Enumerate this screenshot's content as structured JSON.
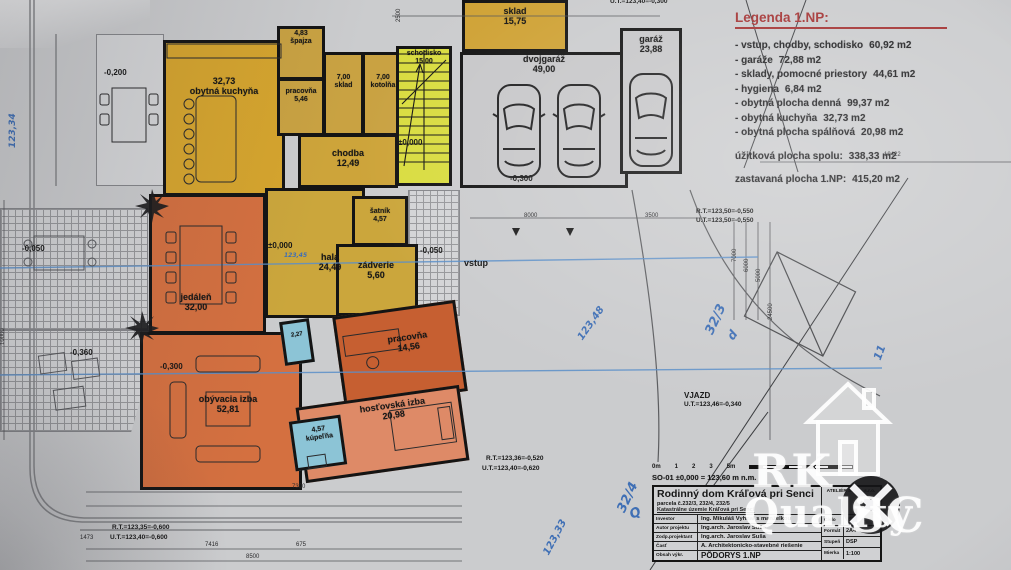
{
  "plan": {
    "rooms": [
      {
        "name": "obytná kuchyňa",
        "area": "32,73"
      },
      {
        "name": "špajza",
        "area": "4,83"
      },
      {
        "name": "pracovňa",
        "area": "5,46"
      },
      {
        "name": "sklad",
        "area": "7,00"
      },
      {
        "name": "kotolňa",
        "area": "7,00"
      },
      {
        "name": "chodba",
        "area": "12,49"
      },
      {
        "name": "schodisko",
        "area": "15,00"
      },
      {
        "name": "sklad",
        "area": "15,75"
      },
      {
        "name": "dvojgaráž",
        "area": "49,00"
      },
      {
        "name": "garáž",
        "area": "23,88"
      },
      {
        "name": "hala",
        "area": "24,49"
      },
      {
        "name": "šatník",
        "area": "4,57"
      },
      {
        "name": "zádverie",
        "area": "5,60"
      },
      {
        "name": "jedáleň",
        "area": "32,00"
      },
      {
        "name": "obývacia izba",
        "area": "52,81"
      },
      {
        "name": "pracovňa",
        "area": "14,56"
      },
      {
        "name": "hosťovská izba",
        "area": "20,98"
      },
      {
        "name": "kúpeľňa",
        "area": "4,57"
      },
      {
        "name": "WC",
        "area": "2,27"
      }
    ],
    "annotations": [
      {
        "text": "±0,000"
      },
      {
        "text": "±0,000"
      },
      {
        "text": "-0,300"
      },
      {
        "text": "-0,200"
      },
      {
        "text": "-0,050"
      },
      {
        "text": "-0,050"
      },
      {
        "text": "-0,300"
      },
      {
        "text": "-0,360"
      },
      {
        "text": "vstup"
      },
      {
        "text": "VJAZD"
      },
      {
        "text": "U.T.=123,46=-0,340"
      },
      {
        "text": "R.T.=123,50=-0,550"
      },
      {
        "text": "U.T.=123,50=-0,550"
      },
      {
        "text": "R.T.=123,36=-0,520"
      },
      {
        "text": "U.T.=123,40=-0,620"
      },
      {
        "text": "R.T.=123,35=-0,600"
      },
      {
        "text": "U.T.=123,40=-0,600"
      },
      {
        "text": "U.T.=123,40=-0,300"
      }
    ],
    "dimensions": [
      "8000",
      "3500",
      "10422",
      "7000",
      "6000",
      "5000",
      "24500",
      "7300",
      "8500",
      "7416",
      "1473",
      "675",
      "2500",
      "10000"
    ],
    "handwritten": [
      {
        "text": "32/3"
      },
      {
        "text": "32/4"
      },
      {
        "text": "123,48"
      },
      {
        "text": "123,33"
      },
      {
        "text": "123,34"
      },
      {
        "text": "Q"
      },
      {
        "text": "11"
      },
      {
        "text": "d"
      },
      {
        "text": "123,45"
      }
    ]
  },
  "legend": {
    "title": "Legenda 1.NP:",
    "items": [
      {
        "label": "- vstup, chodby, schodisko",
        "value": "60,92 m2"
      },
      {
        "label": "- garáže",
        "value": "72,88 m2"
      },
      {
        "label": "- sklady, pomocné priestory",
        "value": "44,61 m2"
      },
      {
        "label": "- hygiena",
        "value": "6,84 m2"
      },
      {
        "label": "- obytná plocha denná",
        "value": "99,37 m2"
      },
      {
        "label": "- obytná kuchyňa",
        "value": "32,73 m2"
      },
      {
        "label": "- obytná plocha spálňová",
        "value": "20,98 m2"
      }
    ],
    "total_usable": {
      "label": "úžitková plocha spolu:",
      "value": "338,33 m2"
    },
    "total_built": {
      "label": "zastavaná plocha 1.NP:",
      "value": "415,20 m2"
    }
  },
  "title_block": {
    "scale_bar": [
      "0m",
      "1",
      "2",
      "3",
      "5m"
    ],
    "ref": "SO-01 ±0,000 = 123,60 m n.m.",
    "project": "Rodinný dom Kráľová pri Senci",
    "parcel": "parcela č.232/3, 232/4, 232/5",
    "cadastre": "Katastrálne územie Kráľová pri Senci",
    "firm": "ATELIÉR SUŠA, s.r.o.",
    "rows": [
      {
        "label": "Investor",
        "value": "Ing. Mikuláš Vyhnal s manželkou"
      },
      {
        "label": "Autor projektu",
        "value": "Ing.arch. Jaroslav Suša"
      },
      {
        "label": "Zodp.projektant",
        "value": "Ing.arch. Jaroslav Suša"
      },
      {
        "label": "Časť",
        "value": "A. Architektonicko-stavebné riešenie"
      },
      {
        "label": "Obsah výkr.",
        "value": "PÔDORYS 1.NP"
      }
    ],
    "meta": [
      {
        "label": "Číslo",
        "value": "05/2011"
      },
      {
        "label": "Formát",
        "value": "2A4"
      },
      {
        "label": "Stupeň",
        "value": "DSP"
      },
      {
        "label": "Mierka",
        "value": "1:100"
      }
    ]
  },
  "watermark": {
    "rk": "RK",
    "quality": "Quality",
    "sc": "SC"
  }
}
